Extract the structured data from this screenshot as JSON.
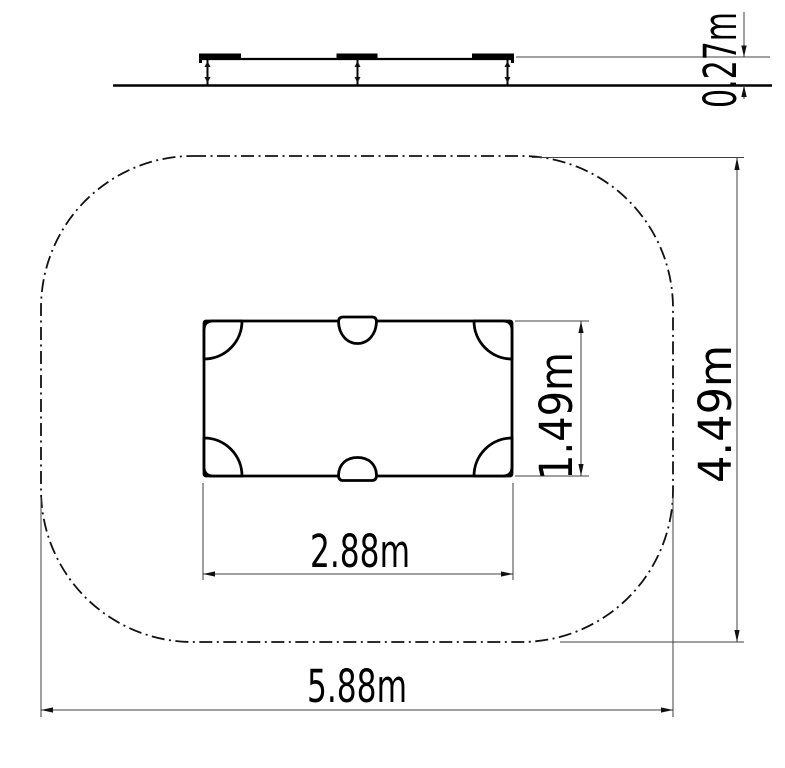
{
  "drawing": {
    "type": "technical-drawing",
    "views": [
      "side-elevation",
      "plan-view"
    ],
    "line_styles": {
      "object_line": "#000000",
      "dimension_line": "#404040",
      "safety_zone_style": "dash-dot"
    },
    "background": "#ffffff"
  },
  "dimensions": {
    "platform_height": {
      "label": "0.27m",
      "meters": 0.27,
      "orientation": "vertical",
      "view": "side-elevation"
    },
    "platform_depth": {
      "label": "1.49m",
      "meters": 1.49,
      "orientation": "vertical",
      "view": "plan-view"
    },
    "zone_depth": {
      "label": "4.49m",
      "meters": 4.49,
      "orientation": "vertical",
      "view": "plan-view"
    },
    "platform_width": {
      "label": "2.88m",
      "meters": 2.88,
      "orientation": "horizontal",
      "view": "plan-view"
    },
    "zone_width": {
      "label": "5.88m",
      "meters": 5.88,
      "orientation": "horizontal",
      "view": "plan-view"
    }
  }
}
